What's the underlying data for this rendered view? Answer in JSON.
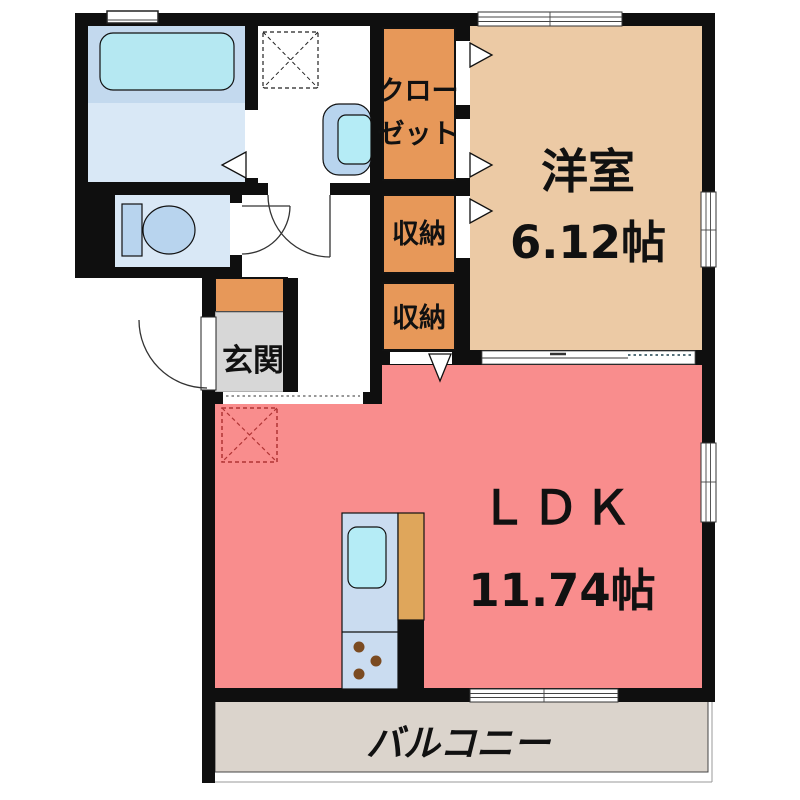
{
  "colors": {
    "wall": "#0f0f0f",
    "western_room_floor": "#eccaa5",
    "ldk_floor": "#f98d8d",
    "storage_fill": "#e79859",
    "counter_fill": "#dfa65b",
    "balcony_floor": "#dbd4cc",
    "entrance_floor": "#d7d7d7",
    "bath_upper_floor": "#c3d9ee",
    "bath_lower_floor": "#d9e8f6",
    "toilet_floor": "#d9e8f6",
    "bathtub_fill": "#b5e8f2",
    "fixture_blue": "#b8d4ee",
    "kitchen_fill": "#cadcf0",
    "sink_fill": "#b5ecf6",
    "burner_brown": "#7b4b21",
    "fridge_outline": "#b03535"
  },
  "labels": {
    "western_room": "洋室",
    "western_room_size": "6.12帖",
    "ldk": "ＬＤＫ",
    "ldk_size": "11.74帖",
    "closet_line1": "クロー",
    "closet_line2": "ゼット",
    "storage_upper": "収納",
    "storage_lower": "収納",
    "entrance": "玄関",
    "balcony": "バルコニー"
  }
}
